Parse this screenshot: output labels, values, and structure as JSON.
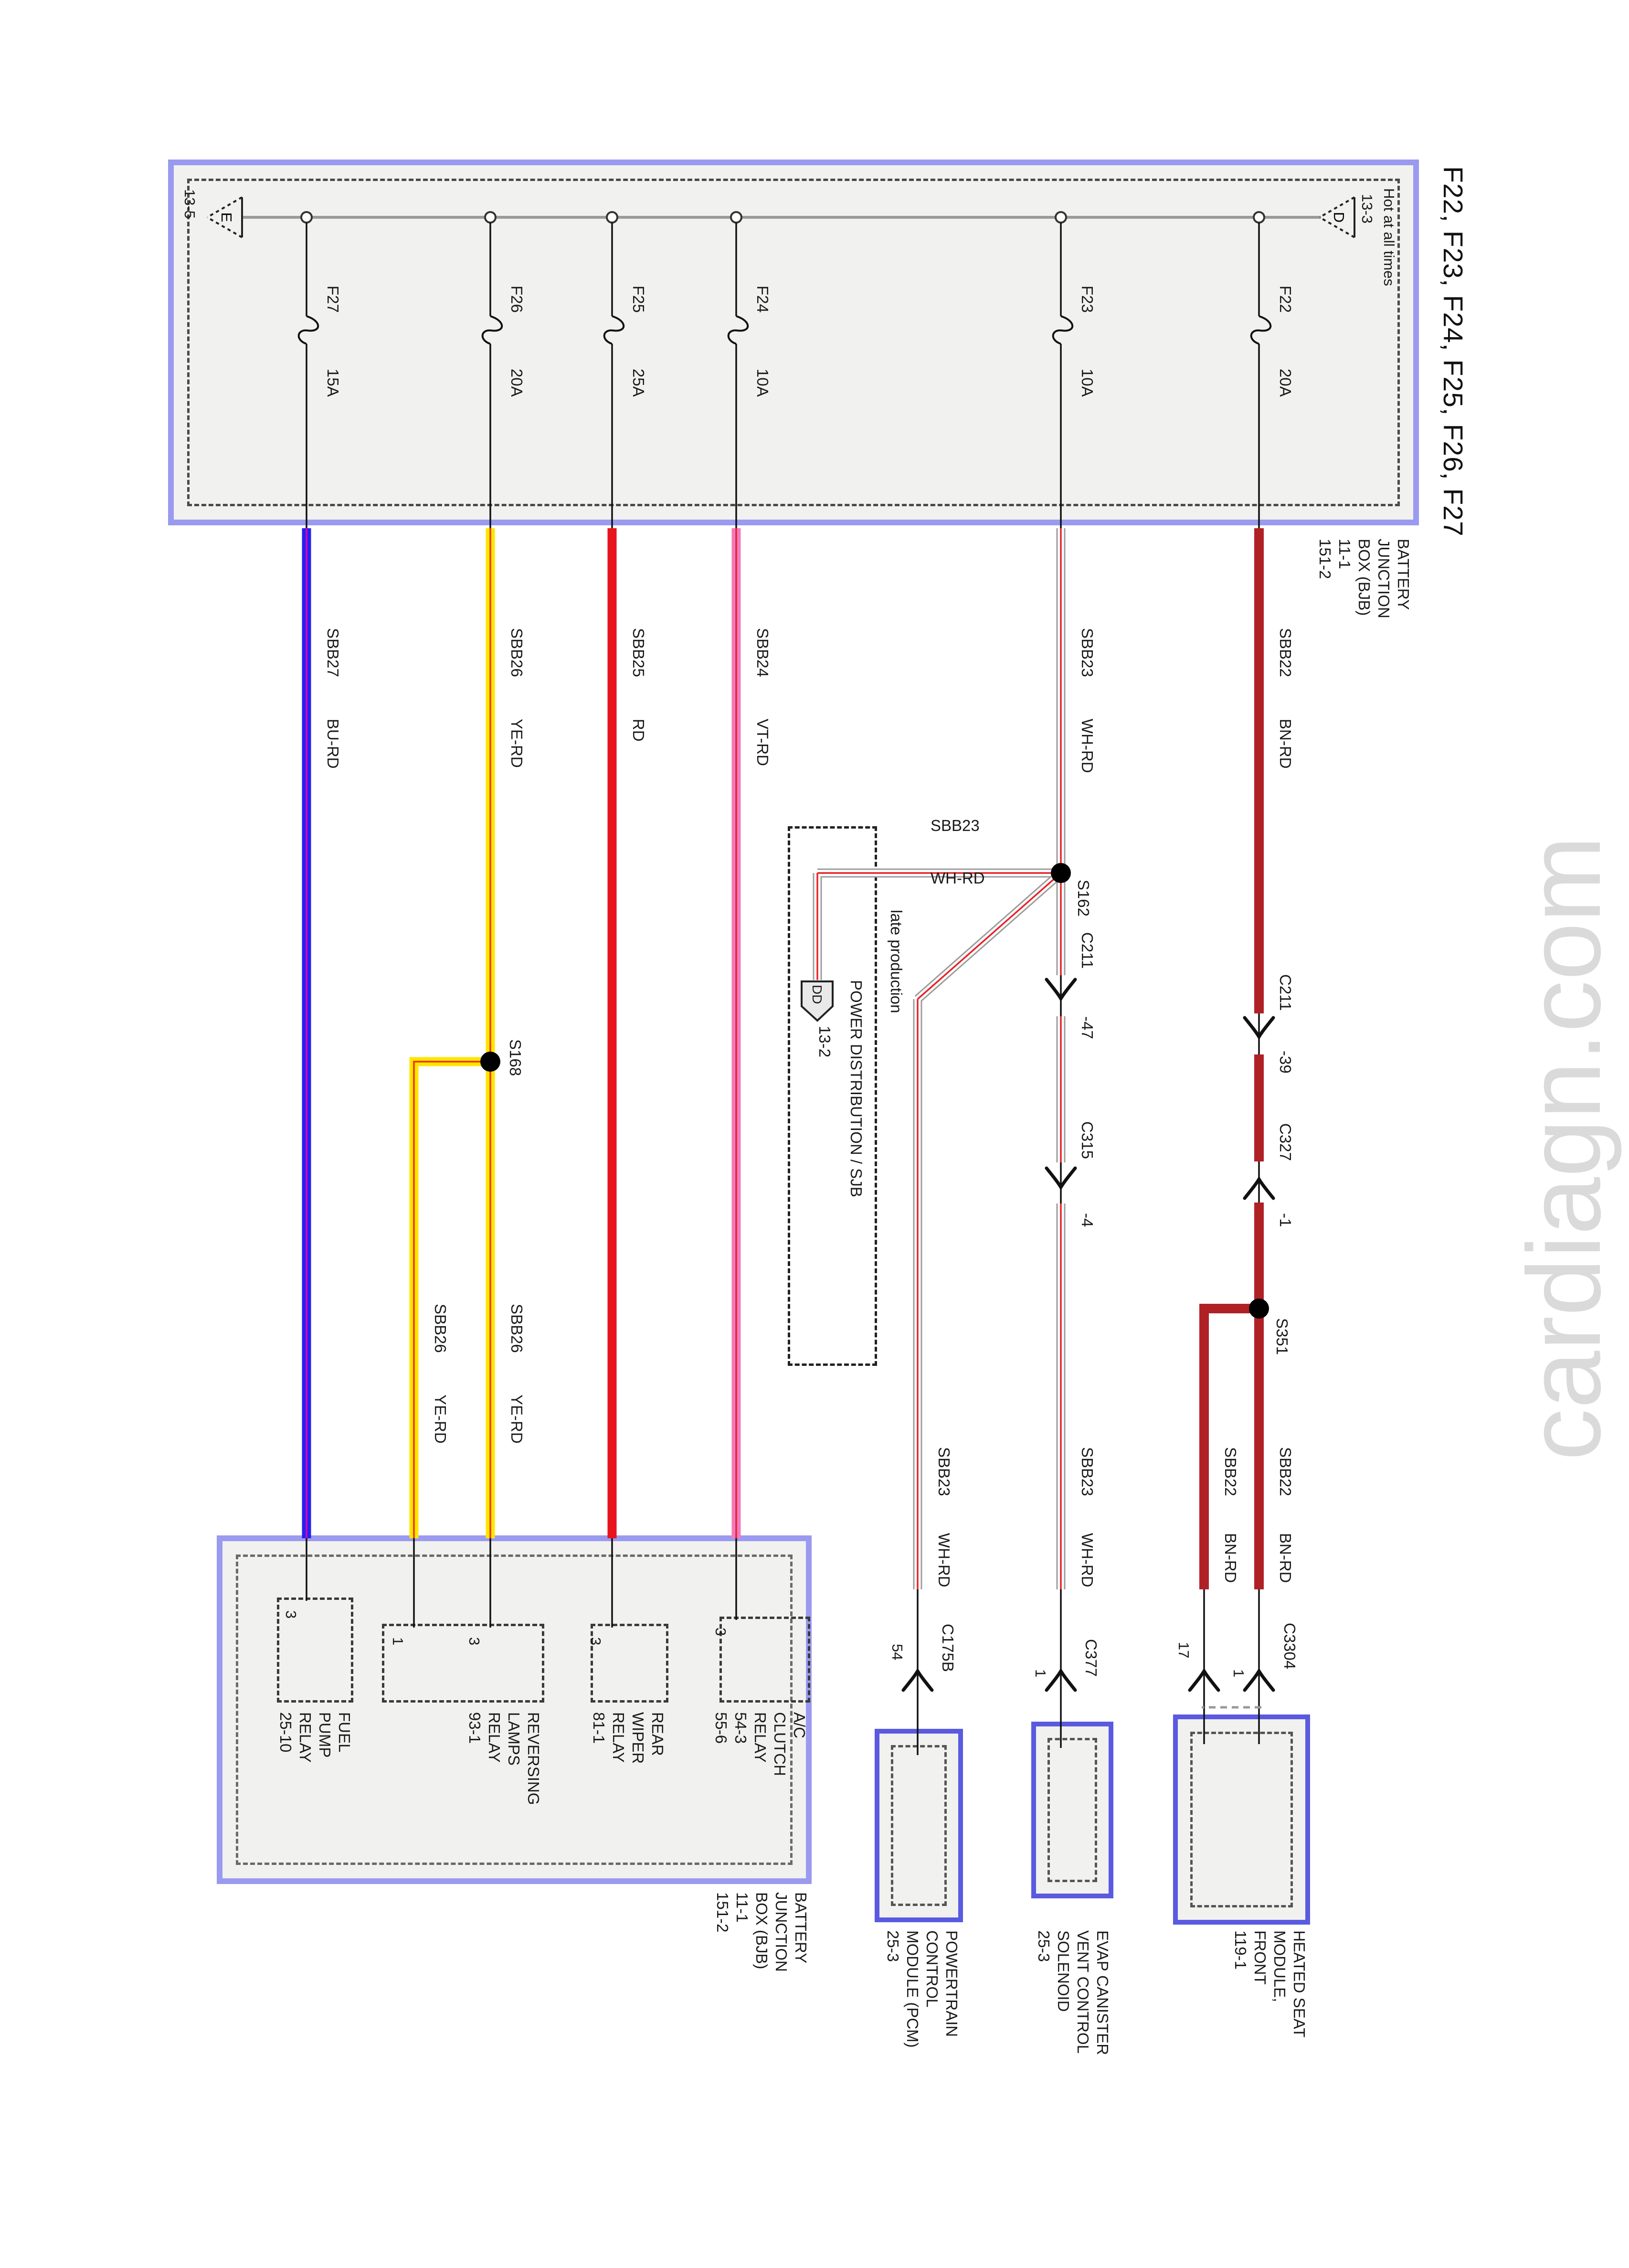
{
  "title": "F22, F23, F24, F25, F26, F27",
  "watermark": "cardiagn.com",
  "colors": {
    "box_border": "#9a9af0",
    "component_border": "#5a5ae0",
    "bus_gray": "#9a9a9a",
    "bn_rd": "#b02126",
    "rd": "#e8131d",
    "ye": "#ffe600",
    "ye_stripe": "#ee3300",
    "vt": "#f27bc0",
    "bu": "#2222ee",
    "bu_stripe": "#cc00bb",
    "wh_outline": "#9c9c9c",
    "stripe_red": "#e8232a",
    "watermark_gray": "#dadada"
  },
  "bus": {
    "hot": "Hot at all times",
    "top_ref": "13-3",
    "top_letter": "D",
    "bottom_ref": "13-5",
    "bottom_letter": "E"
  },
  "bjb_top": {
    "lines": [
      "BATTERY",
      "JUNCTION",
      "BOX (BJB)",
      "11-1",
      "151-2"
    ]
  },
  "rows": [
    {
      "name": "F22",
      "amp": "20A",
      "circuit": "SBB22",
      "color": "BN-RD"
    },
    {
      "name": "F23",
      "amp": "10A",
      "circuit": "SBB23",
      "color": "WH-RD"
    },
    {
      "name": "F24",
      "amp": "10A",
      "circuit": "SBB24",
      "color": "VT-RD"
    },
    {
      "name": "F25",
      "amp": "25A",
      "circuit": "SBB25",
      "color": "RD"
    },
    {
      "name": "F26",
      "amp": "20A",
      "circuit": "SBB26",
      "color": "YE-RD"
    },
    {
      "name": "F27",
      "amp": "15A",
      "circuit": "SBB27",
      "color": "BU-RD"
    }
  ],
  "splices": {
    "s162": "S162",
    "s168": "S168",
    "s351": "S351"
  },
  "connectors": {
    "c211_sbb23": {
      "label": "C211",
      "pin": "-47"
    },
    "c315": {
      "label": "C315",
      "pin": "-4"
    },
    "c211_sbb22": {
      "label": "C211",
      "pin": "-39"
    },
    "c327": {
      "label": "C327",
      "pin": "-1"
    },
    "c175b": {
      "label": "C175B",
      "pin": "54"
    },
    "c377": {
      "label": "C377",
      "pin": "1"
    },
    "c3304": {
      "label": "C3304",
      "pin_upper": "1",
      "pin_lower": "17"
    }
  },
  "sjb": {
    "title": "POWER DISTRIBUTION / SJB",
    "note": "late production",
    "flag": "DD",
    "ref": "13-2"
  },
  "relays": [
    {
      "lines": [
        "FUEL",
        "PUMP",
        "RELAY",
        "25-10"
      ],
      "pin": "3"
    },
    {
      "lines": [
        "REVERSING",
        "LAMPS",
        "RELAY",
        "93-1"
      ],
      "pin1": "1",
      "pin3": "3"
    },
    {
      "lines": [
        "REAR",
        "WIPER",
        "RELAY",
        "81-1"
      ],
      "pin": "3"
    },
    {
      "lines": [
        "A/C",
        "CLUTCH",
        "RELAY",
        "54-3",
        "55-6"
      ],
      "pin": "3"
    }
  ],
  "components": [
    {
      "lines": [
        "POWERTRAIN",
        "CONTROL",
        "MODULE (PCM)",
        "25-3"
      ]
    },
    {
      "lines": [
        "EVAP CANISTER",
        "VENT CONTROL",
        "SOLENOID",
        "25-3"
      ]
    },
    {
      "lines": [
        "HEATED SEAT",
        "MODULE,",
        "FRONT",
        "119-1"
      ]
    }
  ],
  "bjb_bottom": {
    "lines": [
      "BATTERY",
      "JUNCTION",
      "BOX (BJB)",
      "11-1",
      "151-2"
    ]
  }
}
